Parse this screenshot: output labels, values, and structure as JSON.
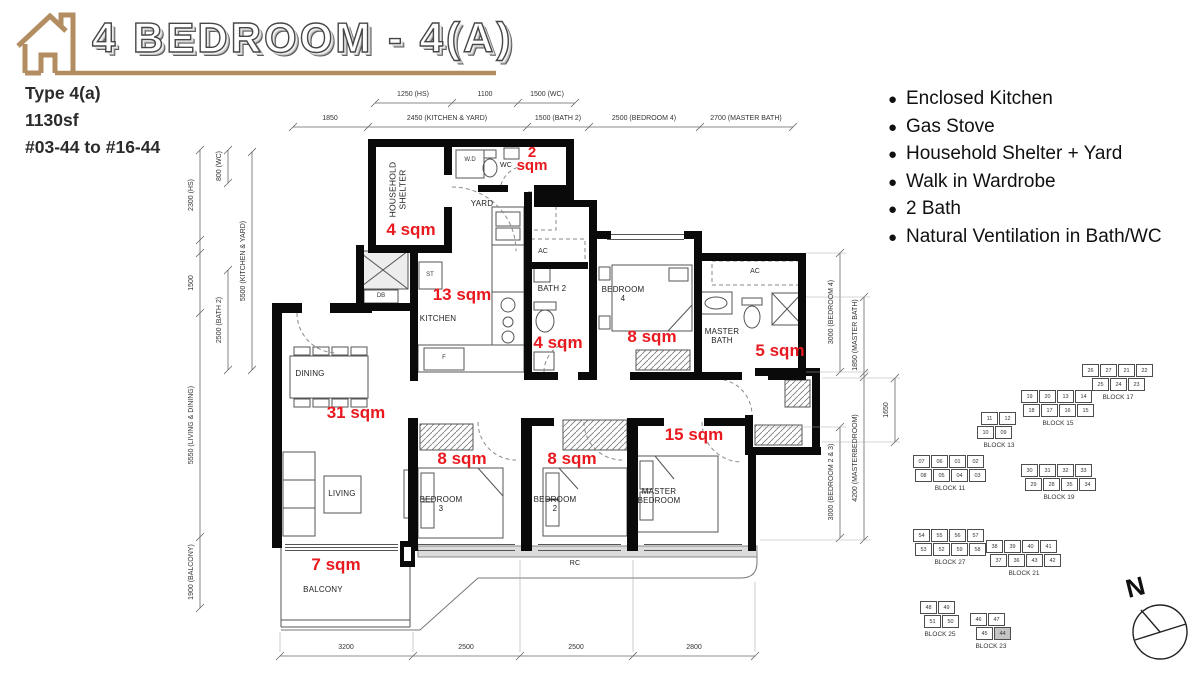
{
  "header": {
    "title": "4 BEDROOM - 4(A)",
    "type_label": "Type 4(a)",
    "size_label": "1130sf",
    "units_label": "#03-44 to #16-44"
  },
  "features": [
    "Enclosed Kitchen",
    "Gas Stove",
    "Household Shelter + Yard",
    "Walk in Wardrobe",
    "2 Bath",
    "Natural Ventilation in Bath/WC"
  ],
  "plan": {
    "rooms": {
      "household_shelter": "HOUSEHOLD SHELTER",
      "yard": "YARD",
      "wc": "WC",
      "kitchen": "KITCHEN",
      "bath2": "BATH 2",
      "bedroom4": "BEDROOM 4",
      "master_bath": "MASTER BATH",
      "dining": "DINING",
      "living": "LIVING",
      "bedroom3": "BEDROOM 3",
      "bedroom2": "BEDROOM 2",
      "master_bedroom": "MASTER BEDROOM",
      "balcony": "BALCONY",
      "rc": "RC"
    },
    "fixtures": {
      "wd": "W.D",
      "st": "ST",
      "db": "DB",
      "f": "F",
      "ac1": "AC",
      "ac2": "AC"
    },
    "areas": {
      "wc": "2 sqm",
      "household_shelter": "4 sqm",
      "kitchen": "13 sqm",
      "bath2": "4 sqm",
      "bedroom4": "8 sqm",
      "master_bath": "5 sqm",
      "living_dining": "31 sqm",
      "bedroom3": "8 sqm",
      "bedroom2": "8 sqm",
      "master_bedroom": "15 sqm",
      "balcony": "7 sqm"
    },
    "dimensions": {
      "top_row1": [
        "1250 (HS)",
        "1100",
        "1500 (WC)"
      ],
      "top_row2": [
        "1850",
        "2450 (KITCHEN & YARD)",
        "1500 (BATH 2)",
        "2500 (BEDROOM 4)",
        "2700 (MASTER BATH)"
      ],
      "left": [
        "2300 (HS)",
        "1500",
        "5550 (LIVING & DINING)",
        "1900 (BALCONY)",
        "800 (WC)",
        "2500 (BATH 2)",
        "5500 (KITCHEN & YARD)"
      ],
      "right": [
        "3000 (BEDROOM 4)",
        "3000 (BEDROOM 2 & 3)",
        "1850 (MASTER BATH)",
        "4200 (MASTERBEDROOM)",
        "1650"
      ],
      "bottom": [
        "3200",
        "2500",
        "2500",
        "2800"
      ]
    }
  },
  "site_plan": {
    "compass_label": "N",
    "highlighted_unit": "44",
    "highlighted_block": "BLOCK 23",
    "blocks": [
      {
        "label": "BLOCK 17",
        "rows": [
          [
            "26",
            "27",
            "21",
            "22"
          ],
          [
            "25",
            "24",
            "23"
          ]
        ]
      },
      {
        "label": "BLOCK 15",
        "rows": [
          [
            "19",
            "20",
            "13",
            "14"
          ],
          [
            "18",
            "17",
            "16",
            "15"
          ]
        ]
      },
      {
        "label": "BLOCK 13",
        "rows": [
          [
            "11",
            "12"
          ],
          [
            "10",
            "09"
          ]
        ]
      },
      {
        "label": "BLOCK 11",
        "rows": [
          [
            "07",
            "06",
            "01",
            "02"
          ],
          [
            "08",
            "05",
            "04",
            "03"
          ]
        ]
      },
      {
        "label": "BLOCK 19",
        "rows": [
          [
            "30",
            "31",
            "32",
            "33"
          ],
          [
            "29",
            "28",
            "35",
            "34"
          ]
        ]
      },
      {
        "label": "BLOCK 27",
        "rows": [
          [
            "54",
            "55",
            "56",
            "57"
          ],
          [
            "53",
            "52",
            "59",
            "58"
          ]
        ]
      },
      {
        "label": "BLOCK 21",
        "rows": [
          [
            "38",
            "39",
            "40",
            "41"
          ],
          [
            "37",
            "36",
            "43",
            "42"
          ]
        ]
      },
      {
        "label": "BLOCK 25",
        "rows": [
          [
            "48",
            "49"
          ],
          [
            "51",
            "50"
          ]
        ]
      },
      {
        "label": "BLOCK 23",
        "rows": [
          [
            "46",
            "47"
          ],
          [
            "45",
            "44"
          ]
        ]
      }
    ]
  },
  "colors": {
    "accent_tan": "#b28d62",
    "annotation_red": "#e8191f",
    "wall_black": "#0a0a0a"
  }
}
